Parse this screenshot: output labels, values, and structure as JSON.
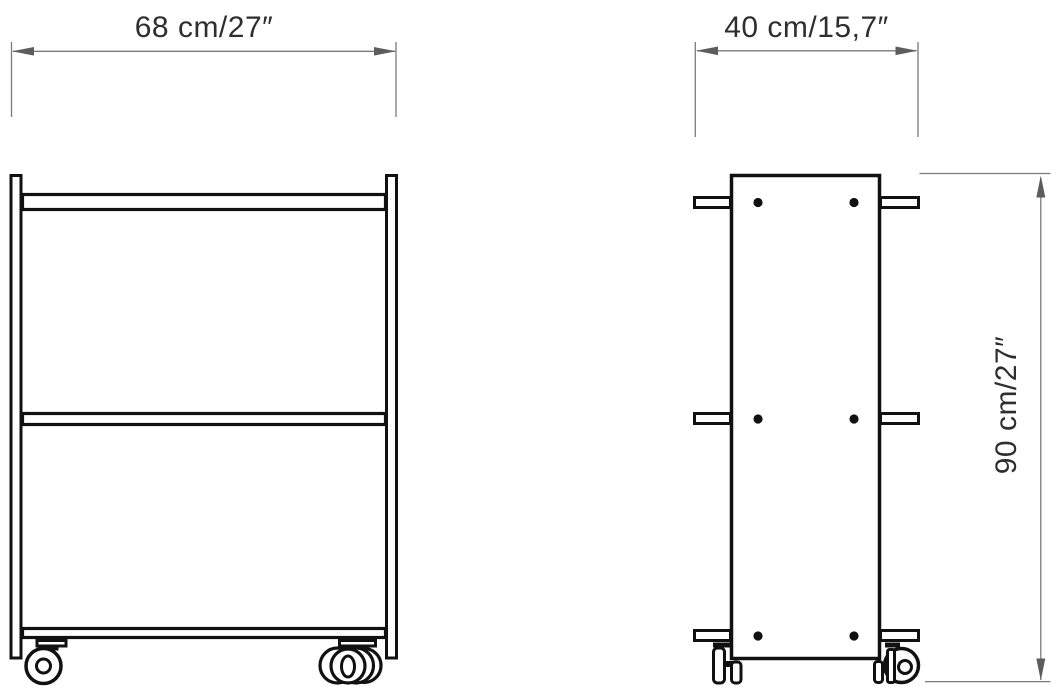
{
  "drawing": {
    "front_view": {
      "width_label": "68 cm/27″"
    },
    "side_view": {
      "depth_label": "40 cm/15,7″",
      "height_label": "90 cm/27″"
    },
    "colors": {
      "outline": "#111111",
      "dimension_line": "#7b7b7b",
      "arrowhead": "#5c5c5c",
      "label_text": "#2e2e2e",
      "background": "#ffffff"
    }
  }
}
